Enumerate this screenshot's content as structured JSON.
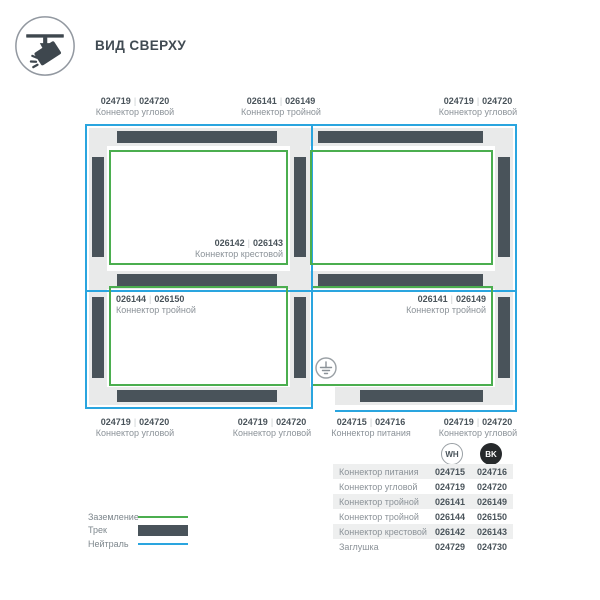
{
  "ui": {
    "separator": "|"
  },
  "header": {
    "title": "ВИД СВЕРХУ",
    "icon": "track-spotlight-top-view-icon"
  },
  "diagram": {
    "labels": [
      {
        "wh": "024719",
        "bk": "024720",
        "name": "Коннектор угловой"
      },
      {
        "wh": "026141",
        "bk": "026149",
        "name": "Коннектор тройной"
      },
      {
        "wh": "024719",
        "bk": "024720",
        "name": "Коннектор угловой"
      },
      {
        "wh": "026142",
        "bk": "026143",
        "name": "Коннектор крестовой"
      },
      {
        "wh": "026144",
        "bk": "026150",
        "name": "Коннектор тройной"
      },
      {
        "wh": "026141",
        "bk": "026149",
        "name": "Коннектор тройной"
      },
      {
        "wh": "024719",
        "bk": "024720",
        "name": "Коннектор угловой"
      },
      {
        "wh": "024719",
        "bk": "024720",
        "name": "Коннектор угловой"
      },
      {
        "wh": "024715",
        "bk": "024716",
        "name": "Коннектор питания"
      },
      {
        "wh": "024719",
        "bk": "024720",
        "name": "Коннектор угловой"
      }
    ],
    "ground_symbol": "ground-icon"
  },
  "legend": {
    "items": [
      {
        "label": "Заземление",
        "swatch": "ground-line",
        "color": "#4BAE4F"
      },
      {
        "label": "Трек",
        "swatch": "track-bar",
        "color": "#49535A"
      },
      {
        "label": "Нейтраль",
        "swatch": "neutral-line",
        "color": "#2AA5DF"
      }
    ]
  },
  "parts_table": {
    "columns": [
      {
        "code": "WH"
      },
      {
        "code": "BK"
      }
    ],
    "rows": [
      {
        "name": "Коннектор питания",
        "wh": "024715",
        "bk": "024716"
      },
      {
        "name": "Коннектор угловой",
        "wh": "024719",
        "bk": "024720"
      },
      {
        "name": "Коннектор тройной",
        "wh": "026141",
        "bk": "026149"
      },
      {
        "name": "Коннектор тройной",
        "wh": "026144",
        "bk": "026150"
      },
      {
        "name": "Коннектор крестовой",
        "wh": "026142",
        "bk": "026143"
      },
      {
        "name": "Заглушка",
        "wh": "024729",
        "bk": "024730"
      }
    ]
  },
  "colors": {
    "track": "#49535A",
    "ground": "#4BAE4F",
    "neutral": "#2AA5DF",
    "track_base": "#E9EAEA",
    "text_dark": "#49535A",
    "text_gray": "#8B9298"
  }
}
